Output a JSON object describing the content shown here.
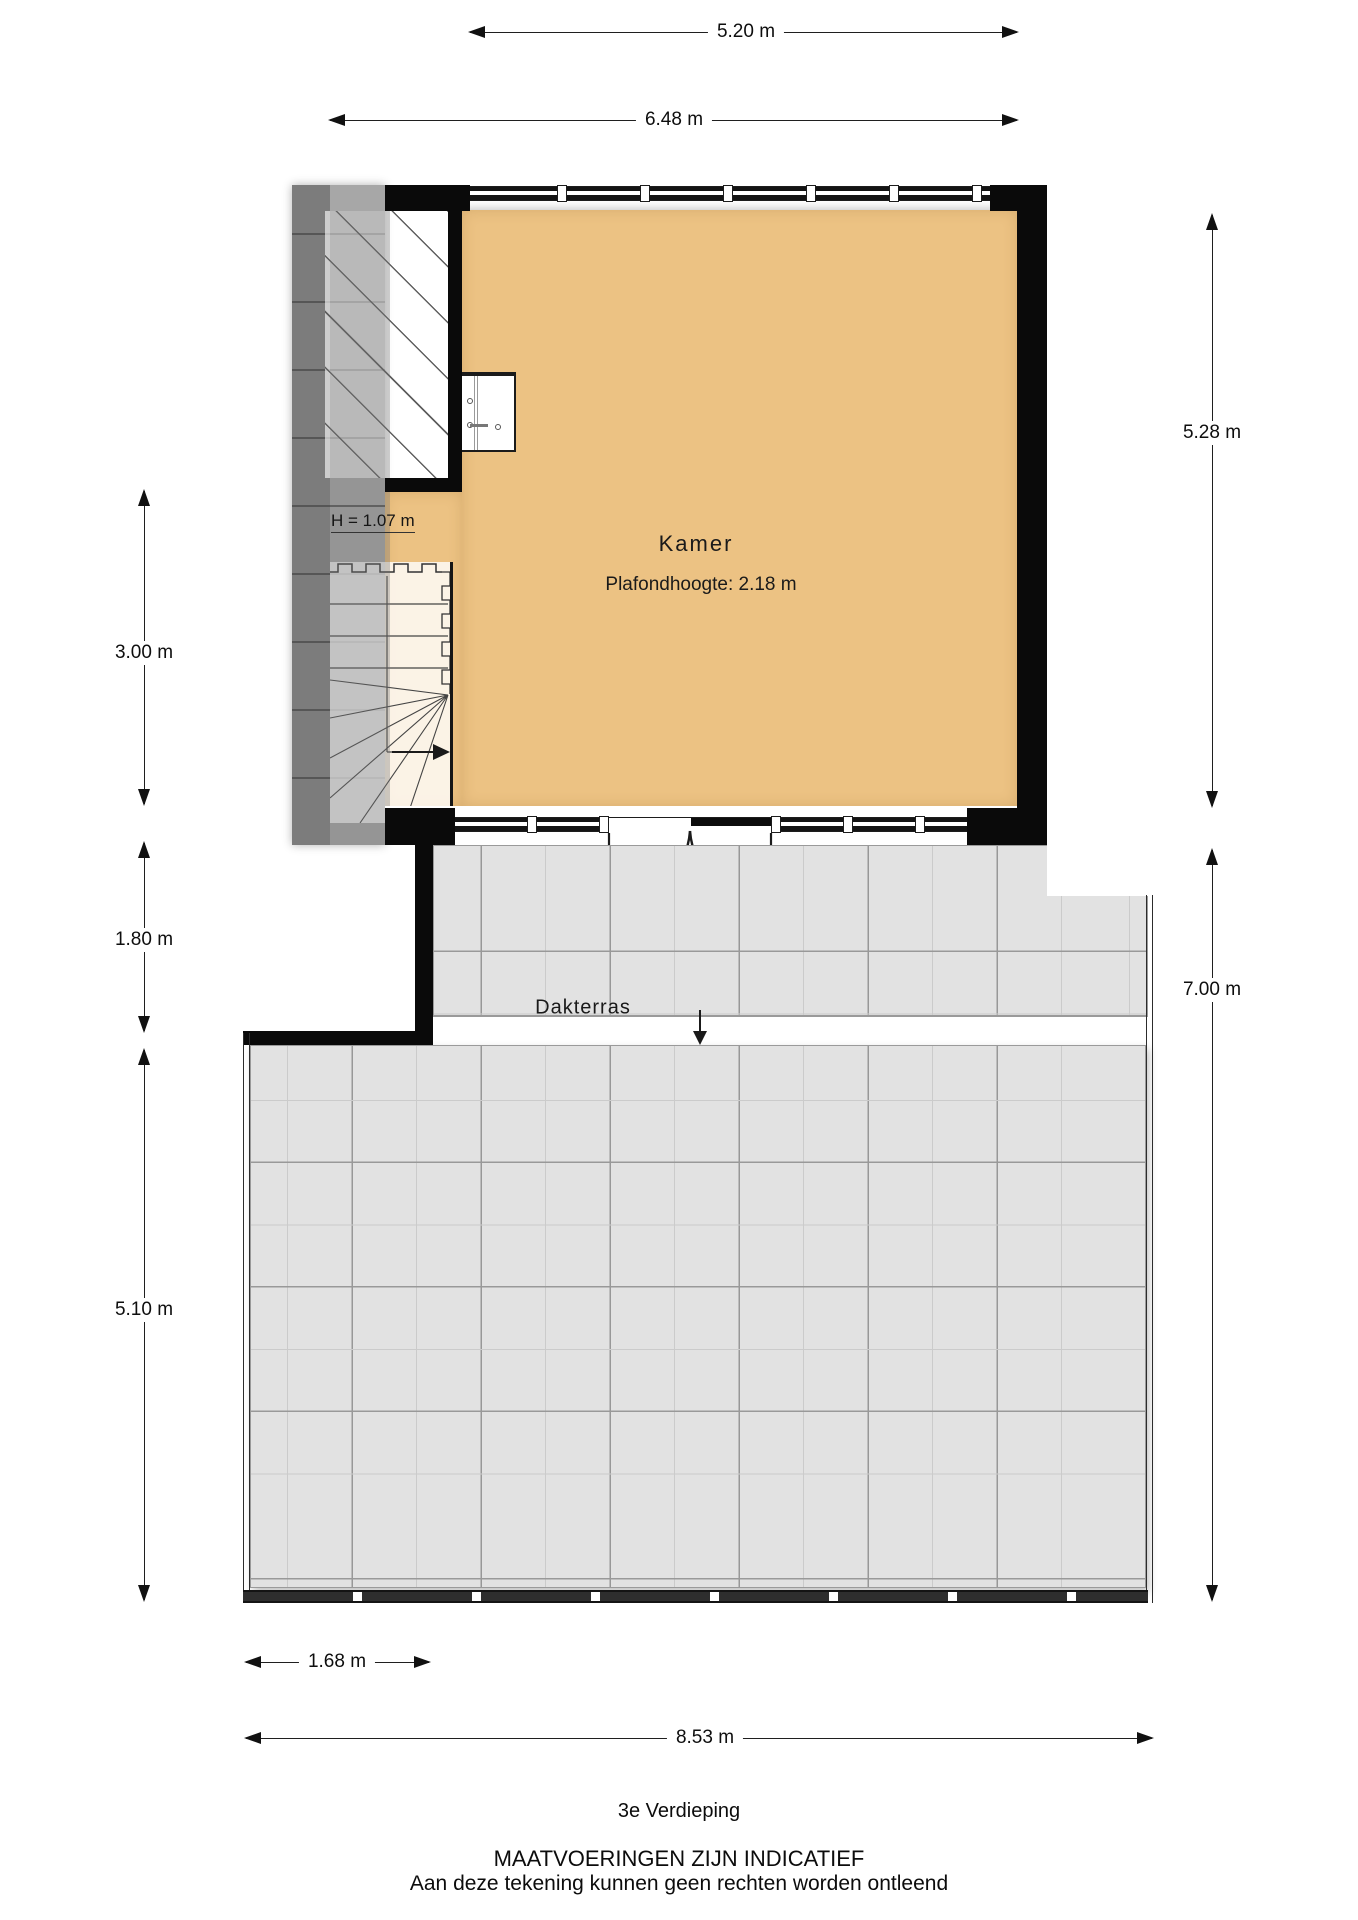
{
  "dimensions": {
    "width_top_inner": "5.20 m",
    "width_top_outer": "6.48 m",
    "room_height_right": "5.28 m",
    "terrace_height_right": "7.00 m",
    "left_upper": "3.00 m",
    "left_mid": "1.80 m",
    "left_lower": "5.10 m",
    "bottom_small": "1.68 m",
    "bottom_total": "8.53 m"
  },
  "rooms": {
    "kamer": {
      "label": "Kamer",
      "ceiling_height": "Plafondhoogte: 2.18 m"
    },
    "dakterras": {
      "label": "Dakterras"
    }
  },
  "annotations": {
    "low_height": "H = 1.07 m"
  },
  "footer": {
    "floor": "3e Verdieping",
    "disclaimer_line1": "MAATVOERINGEN ZIJN INDICATIEF",
    "disclaimer_line2": "Aan deze tekening kunnen geen rechten worden ontleend"
  },
  "colors": {
    "floor": "#ecc283",
    "roof_strip": "#7f7f7f",
    "tile": "#e2e2e2",
    "wall": "#0a0a0a"
  }
}
